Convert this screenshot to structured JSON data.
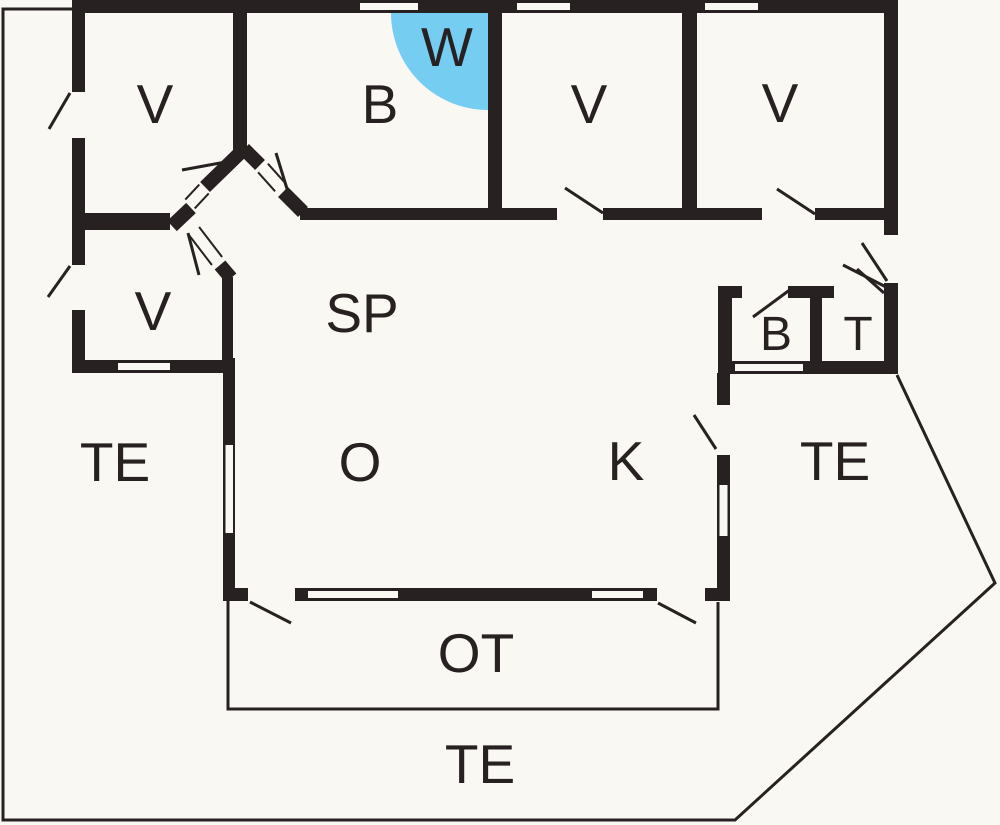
{
  "page": {
    "title": "Floor plan"
  },
  "colors": {
    "background": "#faf8f2",
    "wall": "#272221",
    "water": "#76cdf2"
  },
  "rooms": {
    "v_top_left": {
      "label": "V"
    },
    "b_top": {
      "label": "B"
    },
    "w_top": {
      "label": "W"
    },
    "v_top_mid": {
      "label": "V"
    },
    "v_top_right": {
      "label": "V"
    },
    "v_lower_left": {
      "label": "V"
    },
    "sp_hall": {
      "label": "SP"
    },
    "te_left": {
      "label": "TE"
    },
    "o_living": {
      "label": "O"
    },
    "k_kitchen": {
      "label": "K"
    },
    "b_small": {
      "label": "B"
    },
    "t_toilet": {
      "label": "T"
    },
    "te_right": {
      "label": "TE"
    },
    "ot_porch": {
      "label": "OT"
    },
    "te_bottom": {
      "label": "TE"
    }
  }
}
